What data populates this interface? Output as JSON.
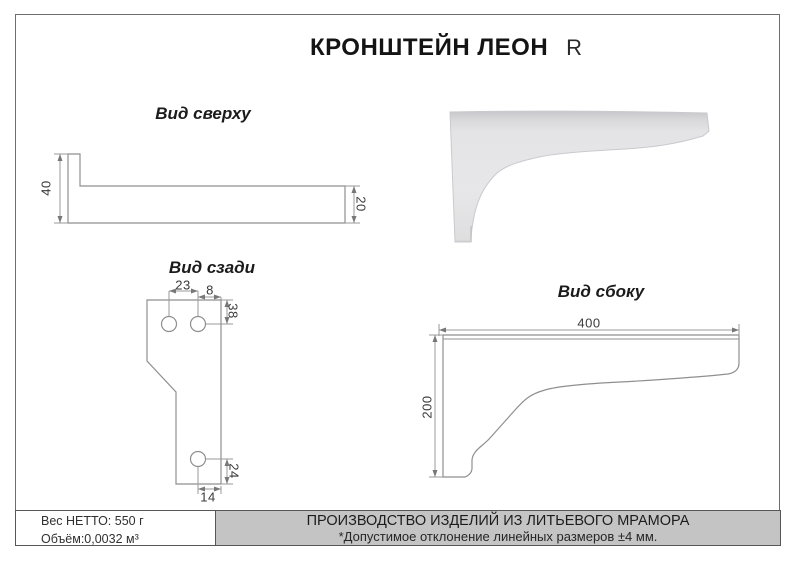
{
  "title": {
    "main": "КРОНШТЕЙН ЛЕОН",
    "variant": "R"
  },
  "views": {
    "top": {
      "label": "Вид сверху",
      "dims": {
        "height_total": "40",
        "bar_width": "20"
      }
    },
    "back": {
      "label": "Вид сзади",
      "dims": {
        "hole_spacing": "23",
        "hole_to_edge": "8",
        "top_to_holes": "38",
        "hole_to_bottom": "24",
        "foot_width": "14"
      }
    },
    "side": {
      "label": "Вид сбоку",
      "dims": {
        "length": "400",
        "height": "200"
      }
    }
  },
  "footer": {
    "weight": "Вес НЕТТО: 550 г",
    "volume": "Объём:0,0032 м³",
    "production_line1": "ПРОИЗВОДСТВО ИЗДЕЛИЙ ИЗ ЛИТЬЕВОГО МРАМОРА",
    "production_line2": "*Допустимое отклонение линейных размеров ±4 мм."
  },
  "colors": {
    "drawing_line": "#8f8f8f",
    "dimension_line": "#9a9a9a",
    "footer_bg": "#c4c4c4",
    "frame_border": "#6e6e6e",
    "render_fill": "#e3e3e5",
    "render_top": "#c7c7cb"
  }
}
